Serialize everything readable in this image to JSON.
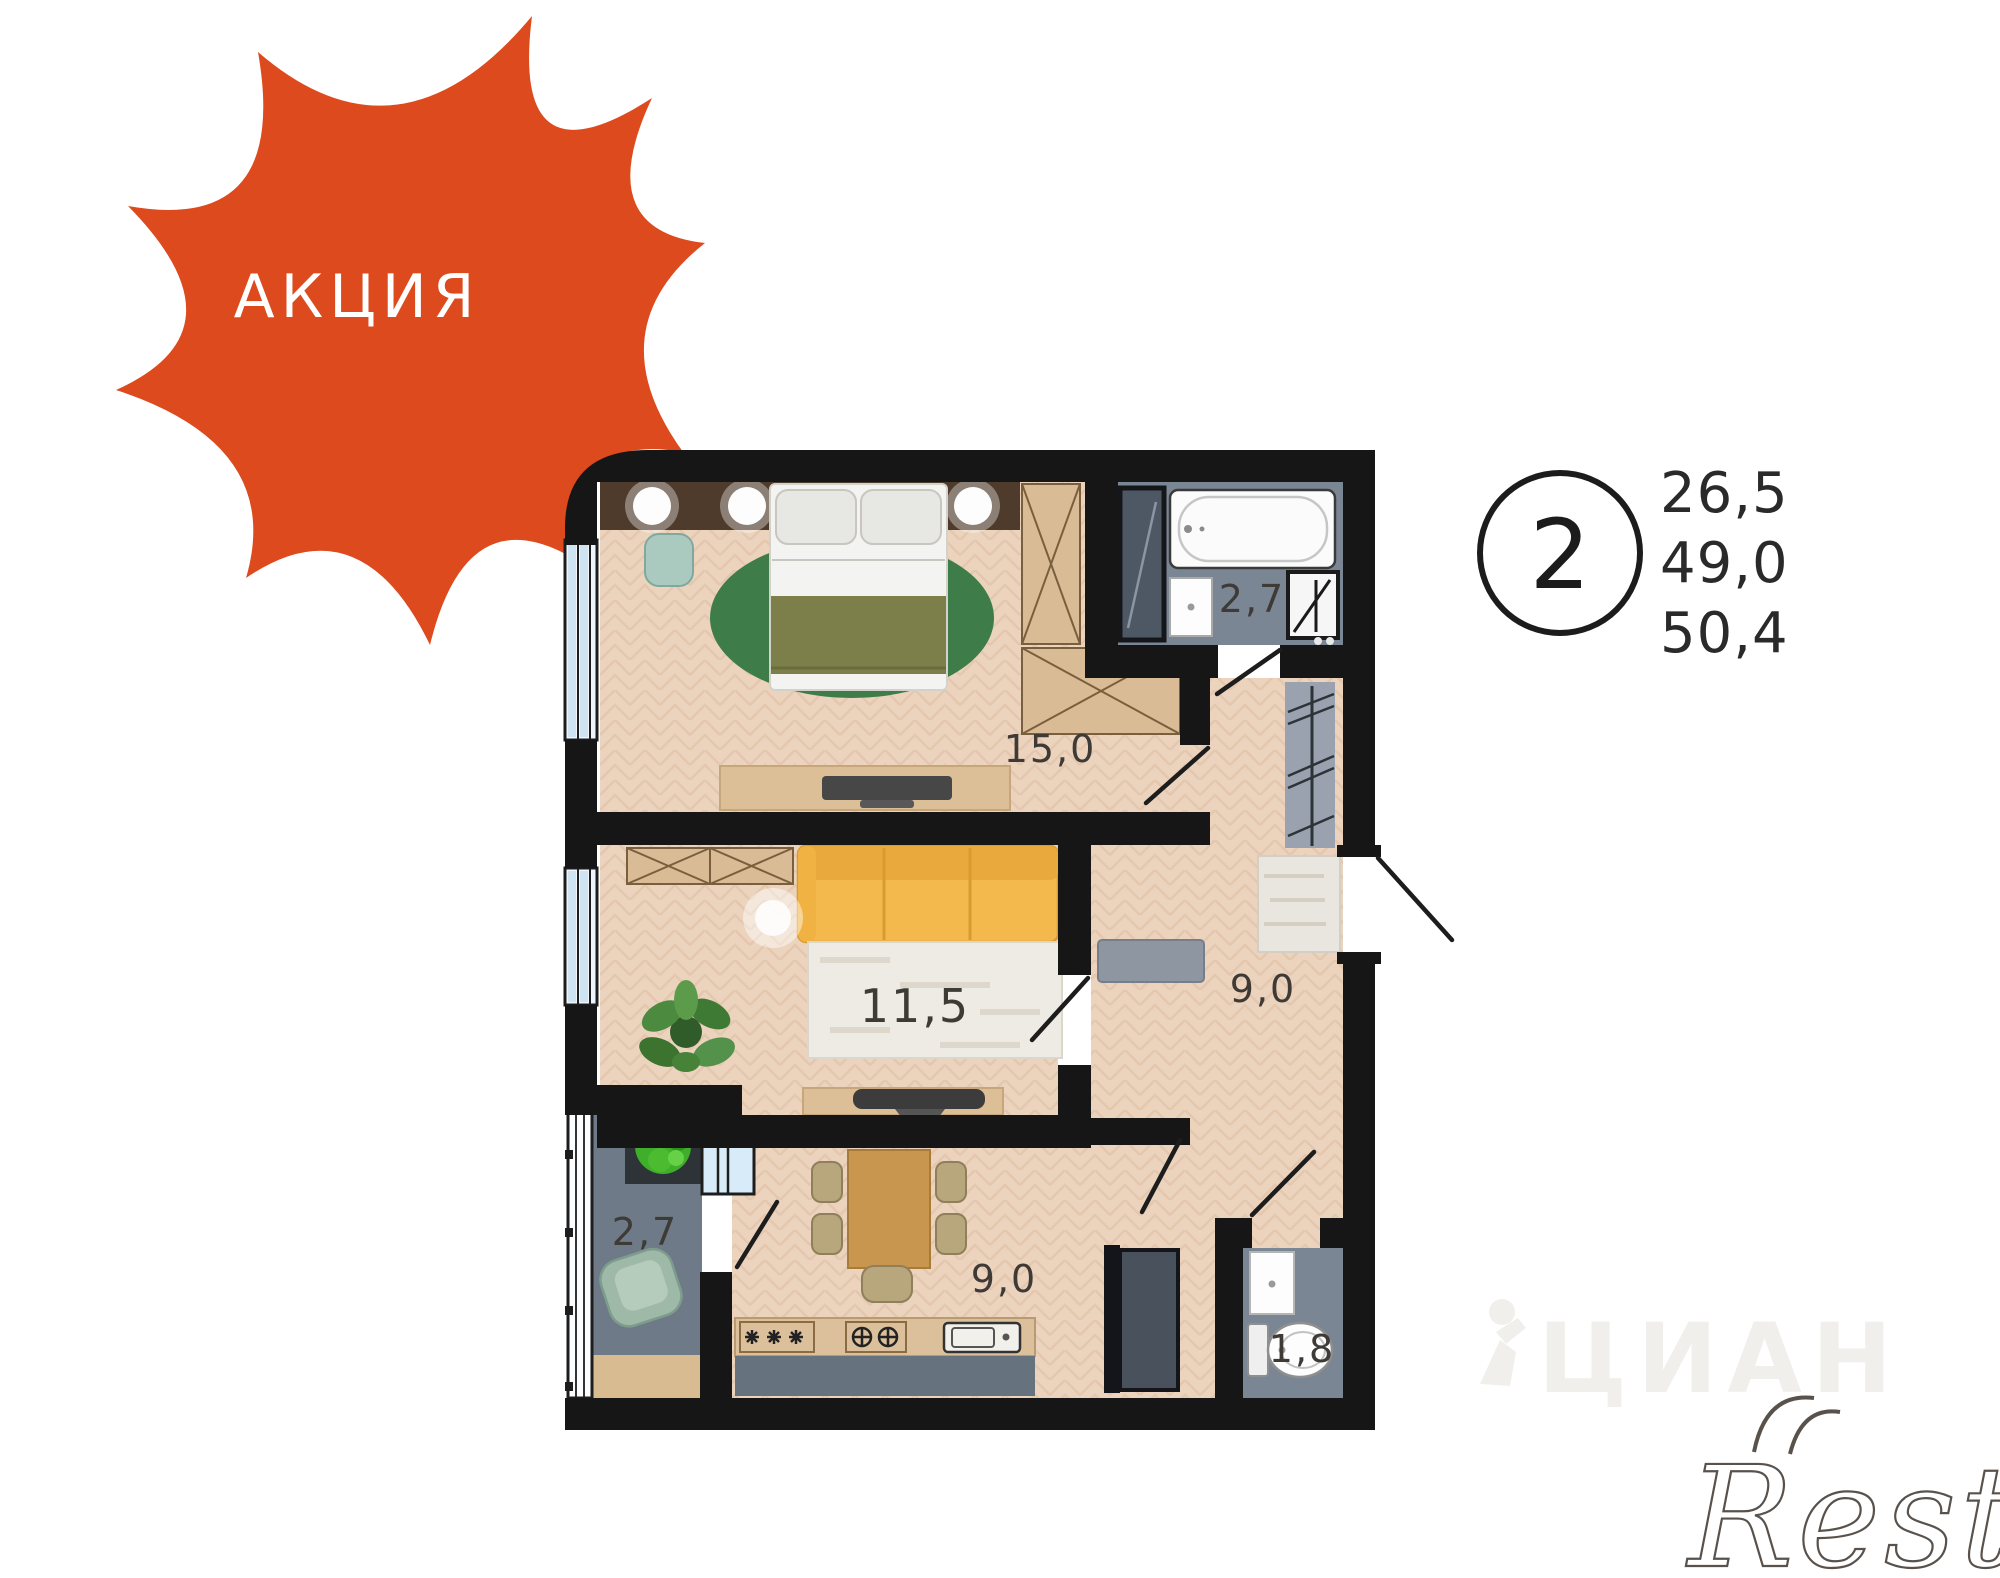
{
  "badge": {
    "label": "АКЦИЯ",
    "color": "#DC4A1E",
    "text_color": "#FFFFFF"
  },
  "legend": {
    "rooms_count": "2",
    "areas": [
      "26,5",
      "49,0",
      "50,4"
    ]
  },
  "plan": {
    "bedroom_area": "15,0",
    "living_area": "11,5",
    "hall_area": "9,0",
    "bathroom_area": "2,7",
    "kitchen_area": "9,0",
    "wc_area": "1,8",
    "balcony_area": "2,7"
  },
  "watermarks": {
    "cian": "ЦИАН",
    "restate": "Restate"
  },
  "colors": {
    "wall": "#161616",
    "wood_floor": "#ECD3BD",
    "gray_floor": "#7B8694",
    "sofa_yellow": "#F3B94D",
    "rug_green": "#3E7C49",
    "label_text": "#3E3A36"
  }
}
